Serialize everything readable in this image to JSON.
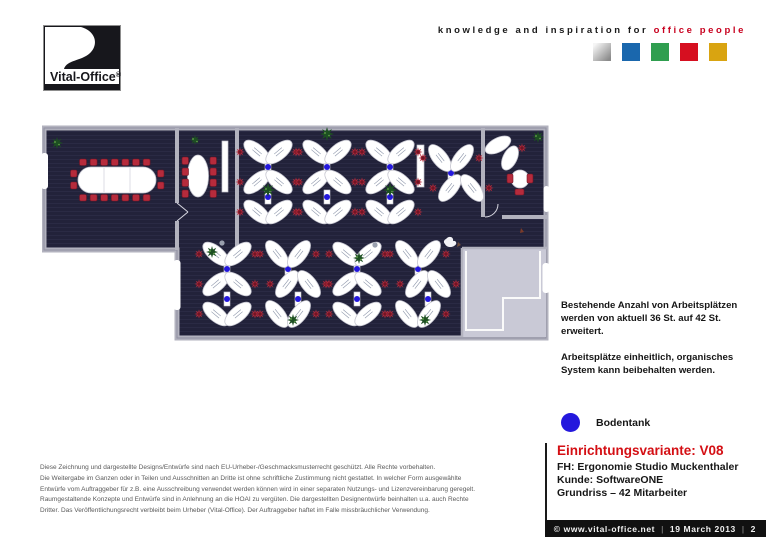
{
  "header": {
    "logo_text": "Vital-Office",
    "logo_reg": "®",
    "tagline_black": "knowledge and inspiration for",
    "tagline_red": "office people",
    "brand_squares": [
      {
        "name": "silver",
        "color": "#b9b9b9",
        "gradient": true
      },
      {
        "name": "blue",
        "color": "#1a67ad"
      },
      {
        "name": "green",
        "color": "#2f9e4f"
      },
      {
        "name": "red",
        "color": "#d60f20"
      },
      {
        "name": "gold",
        "color": "#d9a411"
      }
    ]
  },
  "annotation": {
    "para1": "Bestehende Anzahl von Arbeitsplätzen\nwerden von aktuell 36 St. auf 42 St. erweitert.",
    "para2": "Arbeitsplätze einheitlich, organisches\nSystem kann beibehalten werden."
  },
  "legend": {
    "label": "Bodentank",
    "color": "#2418dd"
  },
  "title_block": {
    "variant": "Einrichtungsvariante: V08",
    "line1": "FH: Ergonomie Studio Muckenthaler",
    "line2": "Kunde: SoftwareONE",
    "line3": "Grundriss – 42 Mitarbeiter",
    "accent_color": "#d40f14"
  },
  "legal": "Diese Zeichnung und dargestellte Designs/Entwürfe sind nach EU-Urheber-/Geschmacksmusterrecht geschützt. Alle Rechte vorbehalten.\nDie Weitergabe im Ganzen oder in Teilen und Ausschnitten an Dritte ist ohne schriftliche Zustimmung nicht gestattet. In welcher Form ausgewählte\nEntwürfe vom Auftraggeber für z.B. eine Ausschreibung verwendet werden können wird in einer separaten Nutzungs- und Lizenzvereinbarung geregelt.\nRaumgestaltende Konzepte und Entwürfe sind in Anlehnung an die HOAI zu vergüten. Die dargestellten Designentwürfe beinhalten u.a. auch Rechte\nDritter. Das Veröffentlichungsrecht verbleibt beim Urheber (Vital-Office). Der Auftraggeber haftet im Falle missbräuchlicher Verwendung.",
  "footer": {
    "copyright": "© www.vital-office.net",
    "date": "19 March 2013",
    "page": "2",
    "separator": "|"
  },
  "floorplan": {
    "colors": {
      "carpet": "#22223a",
      "carpet_stripe": "#2a2a44",
      "wall": "#b2b2be",
      "desk": "#ffffff",
      "desk_edge": "#c5c5cf",
      "chair": "#b62b3c",
      "chair_dark": "#701525",
      "plant": "#1d4f22",
      "plant_light": "#66a84a",
      "bodentank": "#2418dd",
      "entry": "#c9c9d6"
    },
    "clusters": [
      {
        "cx": 226,
        "cy": 28,
        "rows": 3,
        "type": "x"
      },
      {
        "cx": 285,
        "cy": 28,
        "rows": 3,
        "type": "x"
      },
      {
        "cx": 348,
        "cy": 28,
        "rows": 3,
        "type": "x"
      },
      {
        "cx": 414,
        "cy": 34,
        "rows": 2,
        "type": "s"
      },
      {
        "cx": 185,
        "cy": 130,
        "rows": 3,
        "type": "x"
      },
      {
        "cx": 251,
        "cy": 130,
        "rows": 3,
        "type": "s"
      },
      {
        "cx": 315,
        "cy": 130,
        "rows": 3,
        "type": "x"
      },
      {
        "cx": 381,
        "cy": 130,
        "rows": 3,
        "type": "s"
      }
    ],
    "plants": [
      [
        15,
        19,
        6
      ],
      [
        153,
        16,
        5
      ],
      [
        226,
        66,
        7
      ],
      [
        285,
        10,
        7
      ],
      [
        348,
        66,
        7
      ],
      [
        496,
        13,
        6
      ],
      [
        170,
        128,
        6
      ],
      [
        251,
        196,
        6
      ],
      [
        317,
        134,
        6
      ],
      [
        383,
        196,
        6
      ]
    ],
    "extra_chairs": [
      [
        480,
        24
      ]
    ],
    "stools": [
      [
        180,
        119
      ],
      [
        333,
        121
      ]
    ],
    "conference": {
      "chairs_top": 7,
      "chairs_bottom": 7,
      "chairs_side": 2
    },
    "meeting": {
      "chairs_side": 4
    }
  }
}
